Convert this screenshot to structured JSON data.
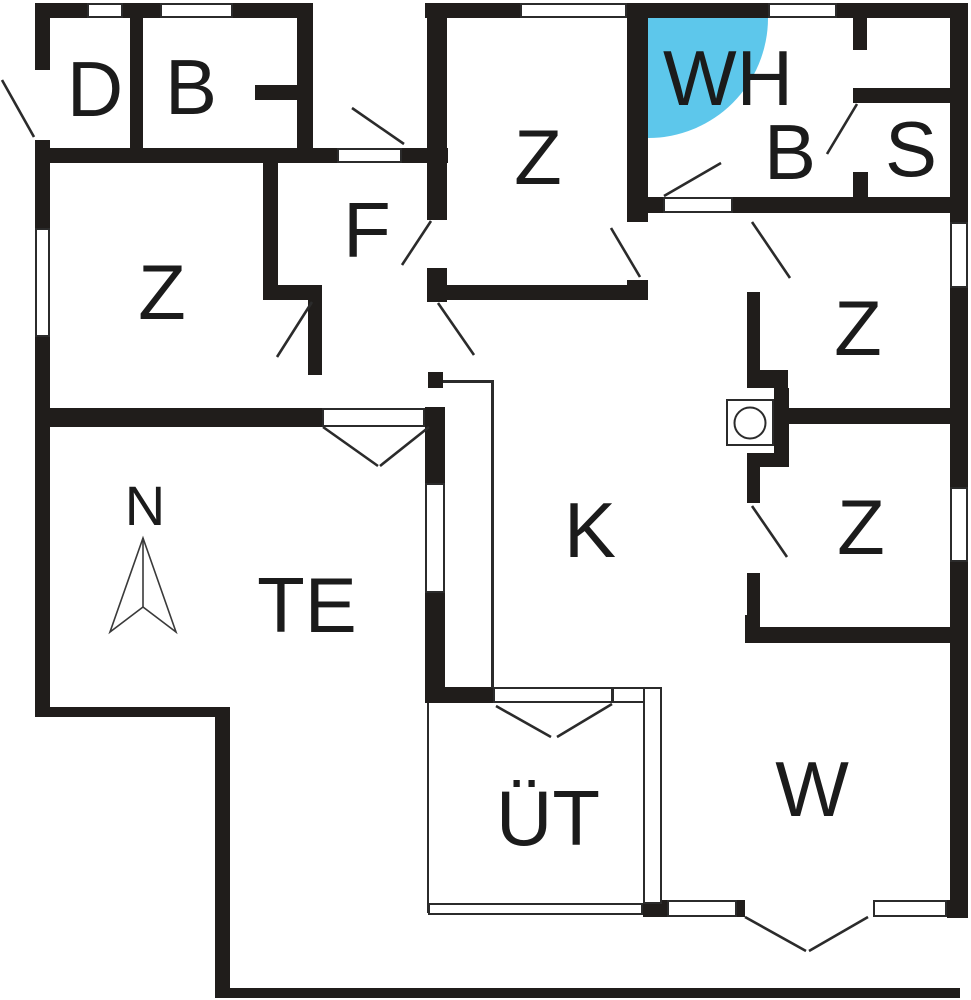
{
  "colors": {
    "wall": "#201d1b",
    "line": "#2b2b2b",
    "whirlpool": "#5dc7eb",
    "background": "#ffffff",
    "label": "#1b1b1b"
  },
  "rooms": {
    "d": "D",
    "b_left": "B",
    "z_left": "Z",
    "f": "F",
    "z_top": "Z",
    "wh": "WH",
    "b_right": "B",
    "s": "S",
    "z_right_upper": "Z",
    "z_right_lower": "Z",
    "k": "K",
    "te": "TE",
    "ut": "ÜT",
    "w": "W"
  },
  "compass": {
    "label": "N"
  },
  "fixtures": {
    "washing_machine": "washing-machine-icon",
    "whirlpool_bath": "whirlpool-icon",
    "north_arrow": "north-arrow-icon"
  }
}
